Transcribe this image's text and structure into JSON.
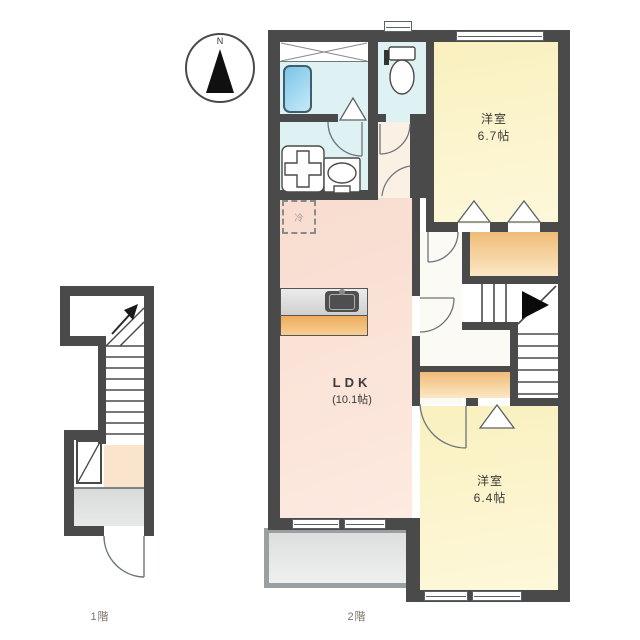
{
  "compass": {
    "north": "N"
  },
  "floor_2f": {
    "label": "2階",
    "ldk": {
      "name": "LDK",
      "size": "(10.1帖)"
    },
    "bedroom_north": {
      "name": "洋室",
      "size": "6.7帖"
    },
    "bedroom_south": {
      "name": "洋室",
      "size": "6.4帖"
    },
    "refrigerator": "冷"
  },
  "floor_1f": {
    "label": "1階"
  },
  "colors": {
    "wall": "#4a4a4a",
    "room_yellow": "#fbf3c9",
    "ldk_pink": "#fae2d6",
    "wet_area_cyan": "#def1f3",
    "closet_orange": "#f2bf7d",
    "balcony_gray": "#dfe1e1",
    "entrance_gray": "#dcdede",
    "hall_peach": "#fae5cc",
    "bathtub_blue": "#7cc4e8"
  }
}
